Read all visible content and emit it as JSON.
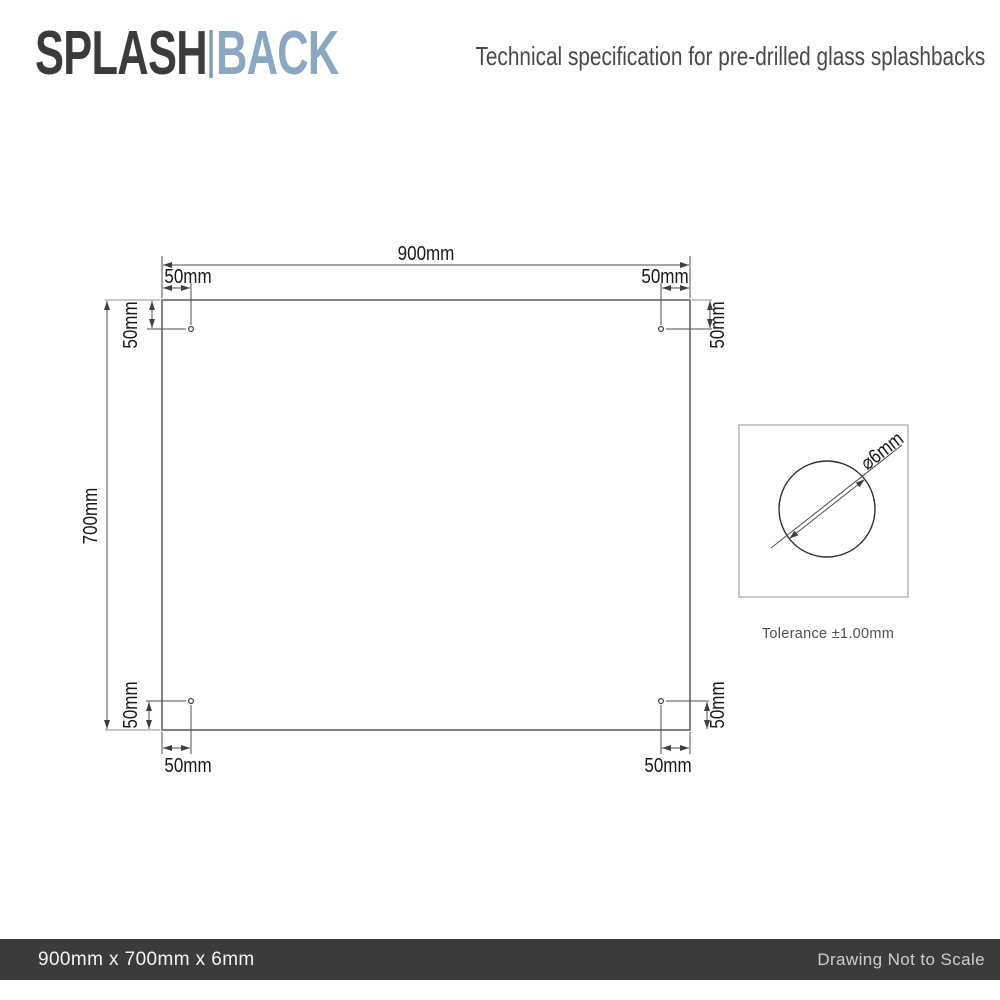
{
  "header": {
    "logo_part1": "SPLASH",
    "logo_part2": "BACK",
    "subtitle": "Technical specification for pre-drilled glass splashbacks"
  },
  "drawing": {
    "panel_width_label": "900mm",
    "panel_height_label": "700mm",
    "hole_offset_label": "50mm",
    "hole_diameter_label": "⌀6mm",
    "tolerance_label": "Tolerance ±1.00mm"
  },
  "footer": {
    "product_dimensions": "900mm x 700mm x 6mm",
    "scale_note": "Drawing Not to Scale"
  },
  "colors": {
    "logo_dark": "#3b3b3b",
    "logo_blue": "#8ca7c2",
    "logo_separator": "#7d9cbd",
    "footer_bar": "#3b3b3b",
    "dimension_line": "#4d4d4d",
    "extension_line": "#8f8f8f",
    "panel_stroke": "#757575"
  }
}
